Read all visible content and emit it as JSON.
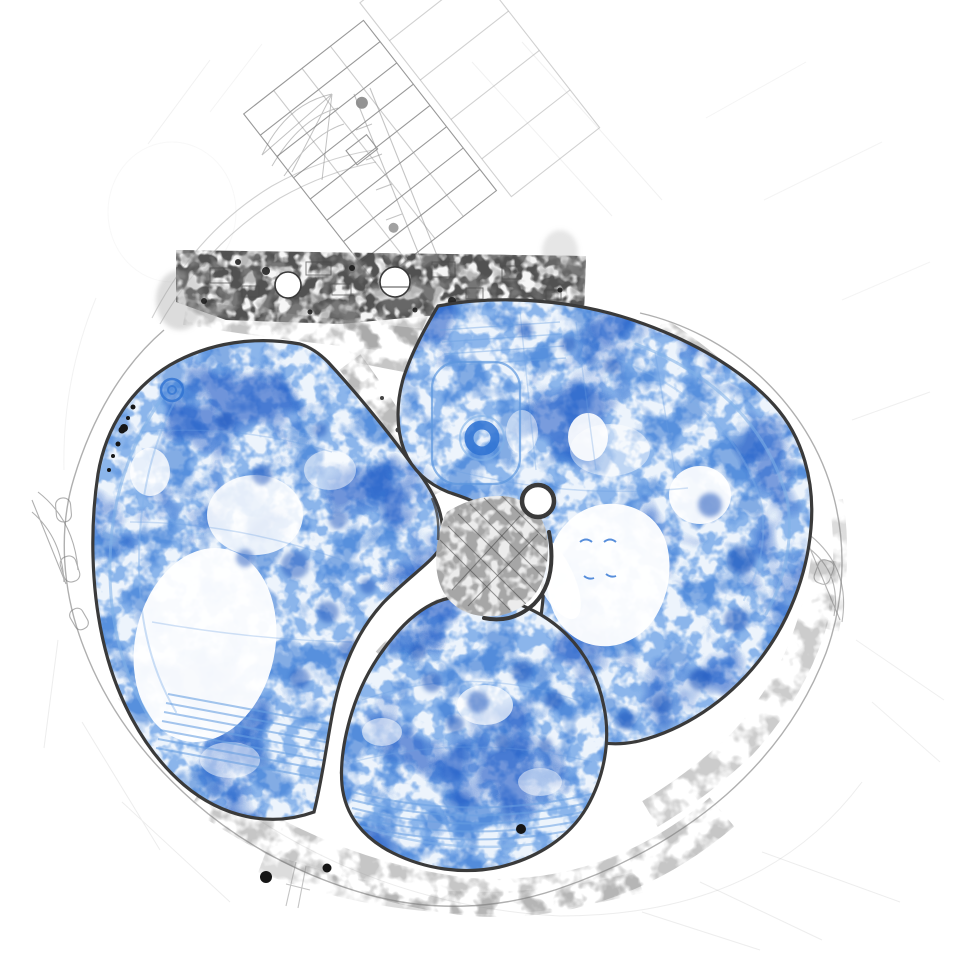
{
  "document": {
    "kind": "architectural site plan sketch",
    "description": "Hand-drawn masterplan map with three organic park zones highlighted in blue scribble texture around a central hatched plaza junction, a dense band of structures to the north, a tilted rectangular building complex at the top, and faint pencil-sketch surroundings",
    "text_content": ""
  },
  "palette": {
    "paper": "#ffffff",
    "zone_base": "#edf4fc",
    "zone_speckle_fine": "#4b8ce0",
    "zone_speckle_mid": "#2e72d2",
    "zone_speckle_coarse": "#1b57c4",
    "zone_arc_detail": "#7fb0e8",
    "zone_arc_strong": "#5b96dd",
    "zone_outline": "#3a3a3a",
    "structures_dark": "#3f3f3f",
    "structures_light": "#8f8f8f",
    "boundary": "#7a7a7a",
    "faint_sketch": "#b8b8b8",
    "plaza_fill": "#ececec",
    "ink_black": "#161616"
  },
  "zones": [
    {
      "id": "west-zone",
      "shade": "blue"
    },
    {
      "id": "northeast-zone",
      "shade": "blue"
    },
    {
      "id": "south-zone",
      "shade": "blue"
    }
  ],
  "features": {
    "central_plaza": "hatched plaza with round knob",
    "north_band": "dense structure band with two circular buildings",
    "tilted_complex": "rotated bar-building grid",
    "donut_ring": "circular blue ring enclosure",
    "white_clearings": "light open areas inside zones"
  }
}
